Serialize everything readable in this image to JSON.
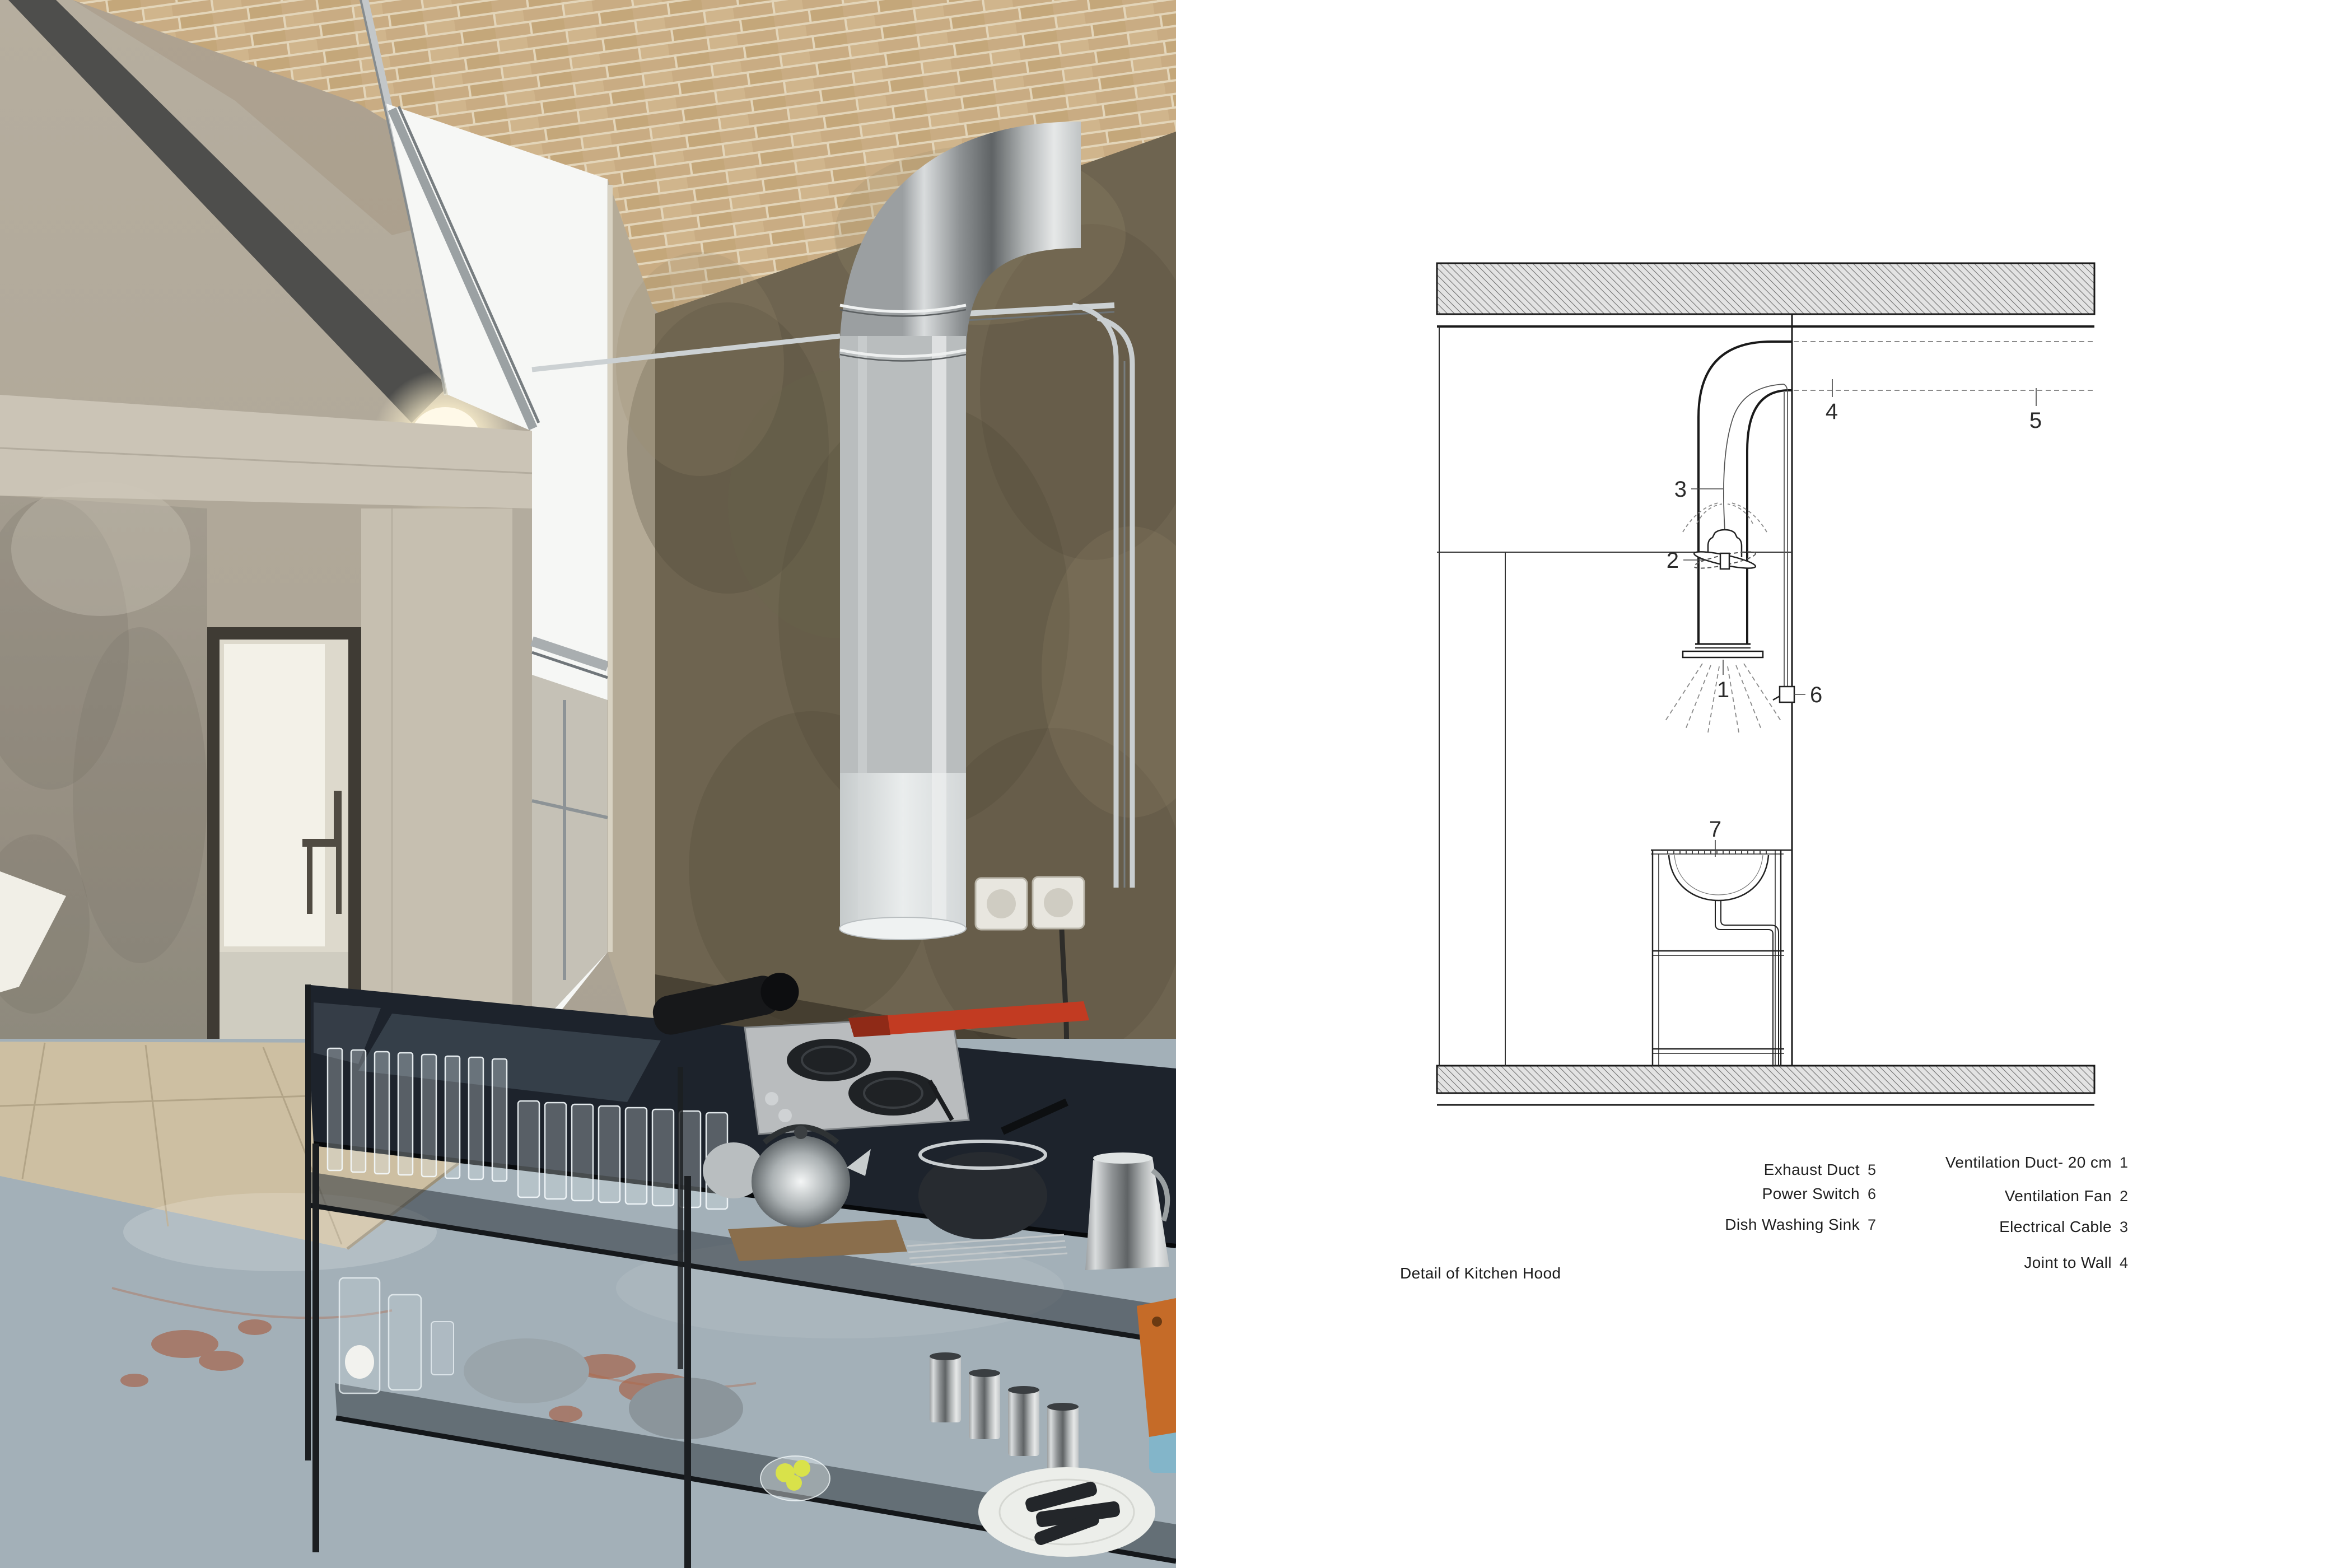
{
  "page": {
    "background": "#ffffff"
  },
  "photo": {
    "description": "industrial kitchen interior: brick vaulted ceiling, concrete walls and doorway, skylight, stainless exhaust duct, black steel console with glassware and cookware",
    "palette": {
      "brick": "#c9ac83",
      "mortar": "#e3d5b9",
      "concrete_beam": "#4e4e4c",
      "plaster": "#9d968a",
      "lintel": "#cbc4b6",
      "jamb": "#c6bfb0",
      "earth_wall": "#6e6450",
      "duct_metal": "#b9bdbe",
      "skylight": "#f6f7f5",
      "floor_blue": "#a3b0b8",
      "platform": "#cdbfa2",
      "stain_red": "#a8502f",
      "table_black": "#1d232c",
      "cooktop_steel": "#b9bcbe",
      "wrench_red": "#c23b22",
      "lemon_yellow": "#d9e24a",
      "board_orange": "#c56b28",
      "cup_blue": "#7fb6cb",
      "outlet_cream": "#e8e6df",
      "spot_glow": "#fff9e8"
    }
  },
  "drawing": {
    "title": "Detail of Kitchen Hood",
    "callouts": {
      "c1": "1",
      "c2": "2",
      "c3": "3",
      "c4": "4",
      "c5": "5",
      "c6": "6",
      "c7": "7"
    },
    "legend_left": [
      {
        "name": "Exhaust Duct",
        "num": "5"
      },
      {
        "name": "Power Switch",
        "num": "6"
      },
      {
        "name": "Dish Washing Sink",
        "num": "7"
      }
    ],
    "legend_right": [
      {
        "name": "Ventilation Duct- 20 cm",
        "num": "1"
      },
      {
        "name": "Ventilation Fan",
        "num": "2"
      },
      {
        "name": "Electrical Cable",
        "num": "3"
      },
      {
        "name": "Joint to Wall",
        "num": "4"
      }
    ],
    "line_color": "#1a1a1a",
    "dash_color": "#8a8a8a",
    "hatch_color": "#707070"
  }
}
